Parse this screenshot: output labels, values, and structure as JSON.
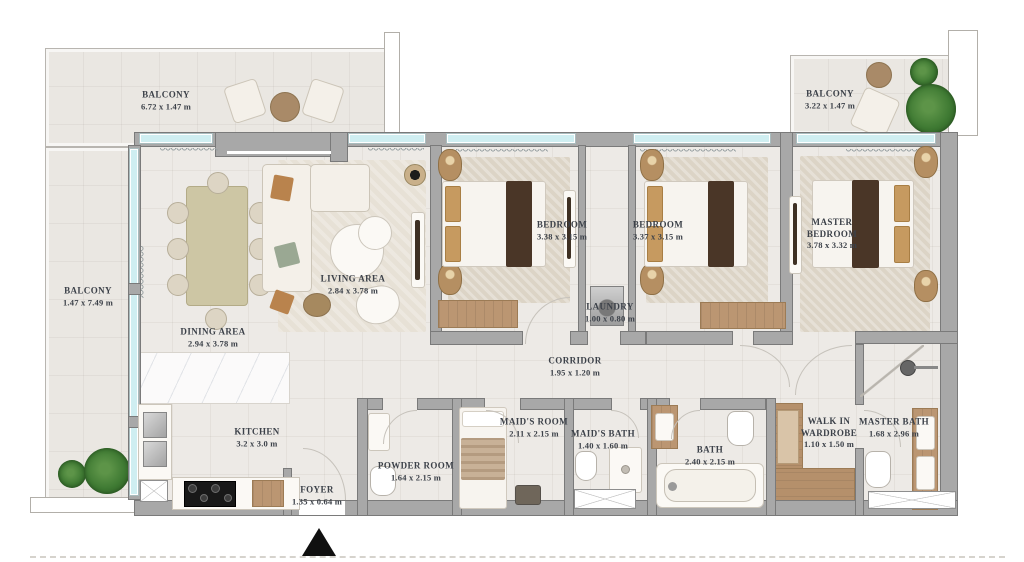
{
  "plan": {
    "type": "apartment-floor-plan",
    "rooms": {
      "balcony_top": {
        "name": "BALCONY",
        "dims": "6.72 x 1.47 m"
      },
      "balcony_left": {
        "name": "BALCONY",
        "dims": "1.47 x 7.49 m"
      },
      "balcony_right": {
        "name": "BALCONY",
        "dims": "3.22 x 1.47 m"
      },
      "dining": {
        "name": "DINING AREA",
        "dims": "2.94 x 3.78 m"
      },
      "living": {
        "name": "LIVING AREA",
        "dims": "2.84 x 3.78 m"
      },
      "kitchen": {
        "name": "KITCHEN",
        "dims": "3.2 x 3.0 m"
      },
      "foyer": {
        "name": "FOYER",
        "dims": "1.35 x 0.64 m"
      },
      "bedroom_1": {
        "name": "BEDROOM",
        "dims": "3.38 x 3.15 m"
      },
      "bedroom_2": {
        "name": "BEDROOM",
        "dims": "3.37 x 3.15 m"
      },
      "master_bedroom": {
        "name": "MASTER BEDROOM",
        "dims": "3.78 x 3.32 m"
      },
      "laundry": {
        "name": "LAUNDRY",
        "dims": "1.00 x 0.80 m"
      },
      "corridor": {
        "name": "CORRIDOR",
        "dims": "1.95 x 1.20 m"
      },
      "powder_room": {
        "name": "POWDER ROOM",
        "dims": "1.64 x 2.15 m"
      },
      "maids_room": {
        "name": "MAID'S ROOM",
        "dims": "2.11 x 2.15 m"
      },
      "maids_bath": {
        "name": "MAID'S BATH",
        "dims": "1.40 x 1.60 m"
      },
      "bath": {
        "name": "BATH",
        "dims": "2.40 x 2.15 m"
      },
      "walk_in_wardrobe": {
        "name": "WALK IN WARDROBE",
        "dims": "1.10 x 1.50 m"
      },
      "master_bath": {
        "name": "MASTER BATH",
        "dims": "1.68 x 2.96 m"
      }
    },
    "icons": {
      "entry_marker": "filled-triangle-up"
    },
    "colors": {
      "wall": "#a8a8a8",
      "wall_outline": "#7a7a7a",
      "floor": "#edeae6",
      "balcony_floor": "#eae7e2",
      "window": "#cfeef1",
      "wood": "#bb9672",
      "dark_wood": "#4a3627",
      "plant": "#3f7a33",
      "label_text": "#3c4149",
      "entry_marker": "#101010"
    }
  }
}
